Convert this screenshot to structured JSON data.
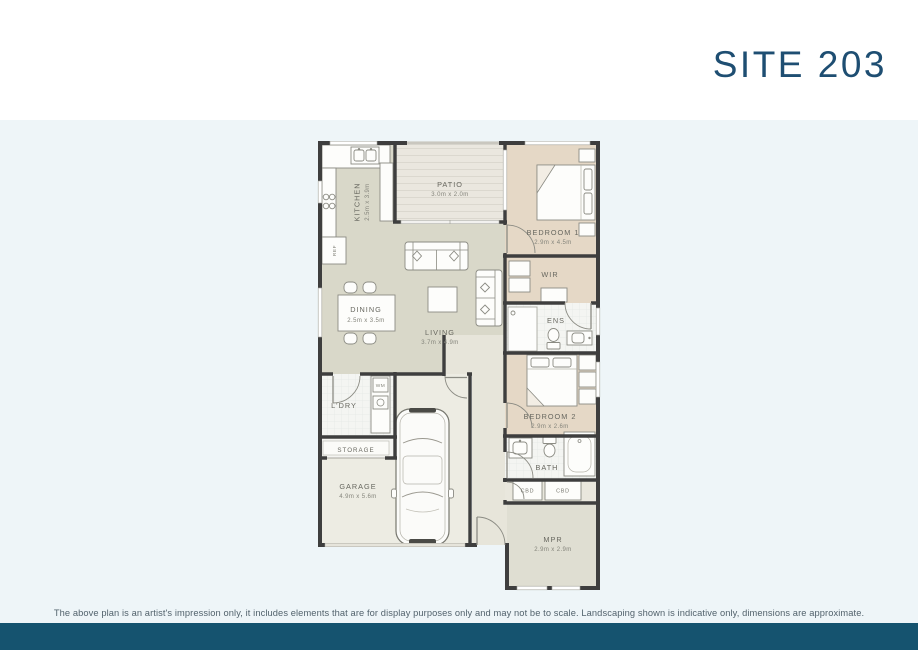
{
  "page": {
    "title": "SITE 203",
    "disclaimer": "The above plan is an artist's impression only, it includes elements that are for display purposes only and may not be to scale. Landscaping shown is indicative only, dimensions are approximate.",
    "colors": {
      "background": "#ffffff",
      "panel_background": "#eef5f8",
      "footer_bar": "#15536f",
      "title_text": "#1e4e72",
      "wall": "#3e3e3e",
      "floor_living": "#d9d8c9",
      "floor_bedroom": "#e5d8c6",
      "floor_wet": "#f4f5f2",
      "floor_garage": "#edece3",
      "floor_hall": "#e7e5da",
      "floor_mpr": "#dfded2",
      "floor_patio": "#eae7df"
    }
  },
  "rooms": {
    "kitchen": {
      "label": "KITCHEN",
      "dims": "2.5m x 3.9m"
    },
    "patio": {
      "label": "PATIO",
      "dims": "3.0m x 2.0m"
    },
    "bedroom1": {
      "label": "BEDROOM 1",
      "dims": "2.9m x 4.5m"
    },
    "wir": {
      "label": "WIR"
    },
    "dining": {
      "label": "DINING",
      "dims": "2.5m x 3.5m"
    },
    "living": {
      "label": "LIVING",
      "dims": "3.7m x 4.9m"
    },
    "ens": {
      "label": "ENS"
    },
    "bedroom2": {
      "label": "BEDROOM 2",
      "dims": "2.9m x 2.6m"
    },
    "ldry": {
      "label": "L'DRY"
    },
    "storage": {
      "label": "STORAGE"
    },
    "bath": {
      "label": "BATH"
    },
    "cbd1": {
      "label": "CBD"
    },
    "cbd2": {
      "label": "CBD"
    },
    "garage": {
      "label": "GARAGE",
      "dims": "4.9m x 5.6m"
    },
    "mpr": {
      "label": "MPR",
      "dims": "2.9m x 2.9m"
    }
  },
  "fixtures": {
    "ref": "REF",
    "wm": "WM"
  }
}
